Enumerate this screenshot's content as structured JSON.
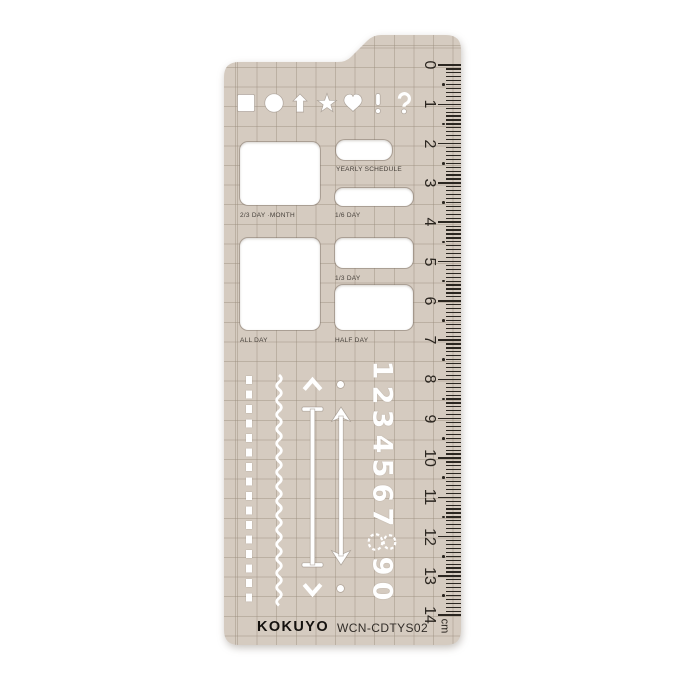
{
  "brand": {
    "logo": "KOKUYO",
    "model": "WCN-CDTYS02"
  },
  "stencil": {
    "shape_row": [
      "square",
      "circle",
      "arrow-up",
      "star",
      "heart",
      "exclamation-mark",
      "question-mark"
    ],
    "cutouts": {
      "month": "2/3 DAY ·MONTH",
      "yearly": "YEARLY SCHEDULE",
      "one_sixth": "1/6 DAY",
      "one_third": "1/3 DAY",
      "all_day": "ALL DAY",
      "half_day": "HALF DAY"
    },
    "digits": [
      "1",
      "2",
      "3",
      "4",
      "5",
      "6",
      "7",
      "8",
      "9",
      "0"
    ]
  },
  "ruler": {
    "numbers": [
      "0",
      "1",
      "2",
      "3",
      "4",
      "5",
      "6",
      "7",
      "8",
      "9",
      "10",
      "11",
      "12",
      "13",
      "14"
    ],
    "unit": "cm"
  },
  "colors": {
    "body": "#d5cbc0",
    "grid": "#9c8f7f",
    "cutout": "#ffffff",
    "ink": "#2b2620",
    "logo_ink": "#14110e"
  }
}
